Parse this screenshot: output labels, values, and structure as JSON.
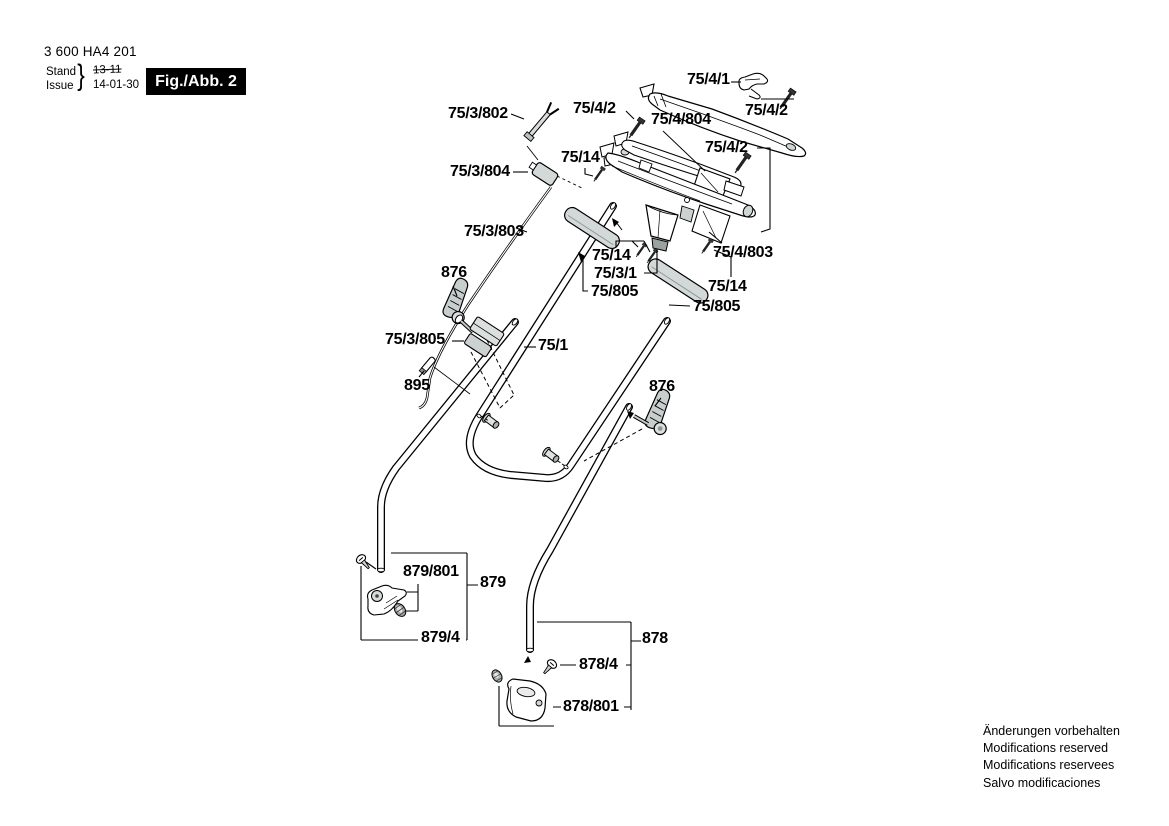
{
  "header": {
    "part_number": "3 600 HA4 201",
    "revision": {
      "stand_label": "Stand",
      "issue_label": "Issue",
      "brace": "}",
      "superseded_date": "13-11",
      "current_date": "14-01-30"
    },
    "figure_label": "Fig./Abb. 2"
  },
  "footer": {
    "disclaimers": [
      "Änderungen vorbehalten",
      "Modifications reserved",
      "Modifications reservees",
      "Salvo modificaciones"
    ]
  },
  "diagram": {
    "description": "Exploded view of mower handle assembly",
    "part_labels": [
      {
        "id": "75-4-1",
        "text": "75/4/1",
        "x": 687,
        "y": 72
      },
      {
        "id": "75-4-2-a",
        "text": "75/4/2",
        "x": 573,
        "y": 101
      },
      {
        "id": "75-4-2-b",
        "text": "75/4/2",
        "x": 745,
        "y": 103
      },
      {
        "id": "75-4-804",
        "text": "75/4/804",
        "x": 651,
        "y": 112
      },
      {
        "id": "75-4-2-c",
        "text": "75/4/2",
        "x": 705,
        "y": 140
      },
      {
        "id": "75-3-802",
        "text": "75/3/802",
        "x": 448,
        "y": 106
      },
      {
        "id": "75-14-a",
        "text": "75/14",
        "x": 561,
        "y": 150
      },
      {
        "id": "75-3-804",
        "text": "75/3/804",
        "x": 450,
        "y": 164
      },
      {
        "id": "75-3-803",
        "text": "75/3/803",
        "x": 464,
        "y": 224
      },
      {
        "id": "876-a",
        "text": "876",
        "x": 441,
        "y": 265
      },
      {
        "id": "75-14-b",
        "text": "75/14",
        "x": 592,
        "y": 248
      },
      {
        "id": "75-3-1",
        "text": "75/3/1",
        "x": 594,
        "y": 266
      },
      {
        "id": "75-805-a",
        "text": "75/805",
        "x": 591,
        "y": 284
      },
      {
        "id": "75-4-803",
        "text": "75/4/803",
        "x": 713,
        "y": 245
      },
      {
        "id": "75-14-c",
        "text": "75/14",
        "x": 708,
        "y": 279
      },
      {
        "id": "75-805-b",
        "text": "75/805",
        "x": 693,
        "y": 299
      },
      {
        "id": "75-3-805",
        "text": "75/3/805",
        "x": 385,
        "y": 332
      },
      {
        "id": "75-1",
        "text": "75/1",
        "x": 538,
        "y": 338
      },
      {
        "id": "895",
        "text": "895",
        "x": 404,
        "y": 378
      },
      {
        "id": "876-b",
        "text": "876",
        "x": 649,
        "y": 379
      },
      {
        "id": "879-801",
        "text": "879/801",
        "x": 403,
        "y": 564
      },
      {
        "id": "879",
        "text": "879",
        "x": 480,
        "y": 575
      },
      {
        "id": "879-4",
        "text": "879/4",
        "x": 421,
        "y": 630
      },
      {
        "id": "878",
        "text": "878",
        "x": 642,
        "y": 631
      },
      {
        "id": "878-4",
        "text": "878/4",
        "x": 579,
        "y": 657
      },
      {
        "id": "878-801",
        "text": "878/801",
        "x": 563,
        "y": 699
      }
    ]
  },
  "colors": {
    "ink": "#000000",
    "shade": "#d3d9d8",
    "shade_dark": "#a7afad",
    "paper": "#ffffff"
  }
}
